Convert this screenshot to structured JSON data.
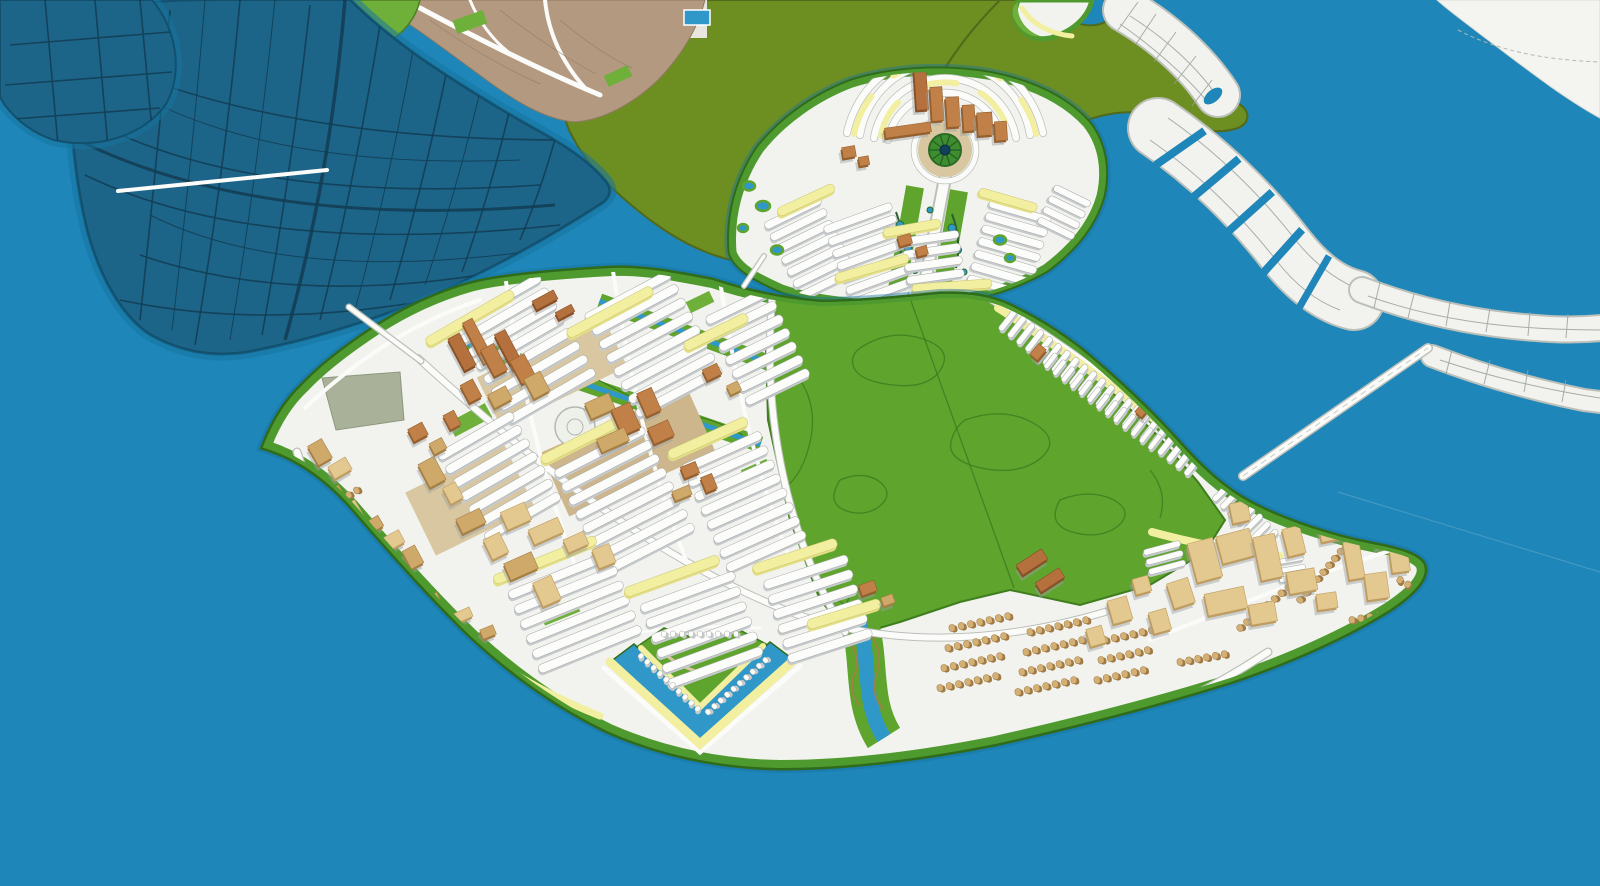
{
  "colors": {
    "water": "#1e86b8",
    "waterEdge": "#17749f",
    "darkIsland": "#1c6589",
    "darkIslandLine": "#123c52",
    "oliveLand": "#6d8e21",
    "oliveEdge": "#51691a",
    "parkGreen": "#5ea42d",
    "parkLine": "#3c7a1e",
    "shoreGreen": "#4f9a2e",
    "shoreDark": "#2f6b1a",
    "brightGreen": "#6fb03a",
    "landWhite": "#f2f3ee",
    "roadWhite": "#fbfbf9",
    "roadCasing": "#bcc0ba",
    "blockLine": "#9aa09e",
    "slabTop": "#fcfcfa",
    "slabSide": "#c6cacc",
    "slabLine": "#a2a7a6",
    "yellow": "#f2efa0",
    "yellowDeep": "#e4df86",
    "tan": "#e3c98f",
    "tanSide": "#bf9d62",
    "tanDark": "#cfa96a",
    "tanDarkSide": "#a67f44",
    "brown": "#c08048",
    "brownSide": "#95602e",
    "red": "#b5713d",
    "redSide": "#8a4f26",
    "houseTan": "#d4b075",
    "houseTanSide": "#a07a45",
    "sand": "#d8c7a0",
    "sandDeep": "#cdb68c",
    "canal": "#2f98c9",
    "sage": "#a9b299",
    "shadow": "#9aa0a3",
    "mainland": "#b3997f",
    "mainlandLine": "#8f7a62"
  },
  "rows": [
    {
      "p": "g-rows-main",
      "x": 497,
      "y": 302,
      "a": -30,
      "l": 100,
      "w": 9,
      "n": 8,
      "pt": 15.5
    },
    {
      "p": "g-rows-main",
      "x": 628,
      "y": 296,
      "a": -28,
      "l": 96,
      "w": 9,
      "n": 8,
      "pt": 15.5
    },
    {
      "p": "g-rows-main",
      "x": 738,
      "y": 306,
      "a": -26,
      "l": 70,
      "w": 9,
      "n": 7,
      "pt": 15
    },
    {
      "p": "g-rows-main",
      "x": 476,
      "y": 436,
      "a": -30,
      "l": 86,
      "w": 9,
      "n": 7,
      "pt": 15.5
    },
    {
      "p": "g-rows-main",
      "x": 600,
      "y": 452,
      "a": -27,
      "l": 100,
      "w": 9,
      "n": 8,
      "pt": 15.5
    },
    {
      "p": "g-rows-main",
      "x": 722,
      "y": 452,
      "a": -24,
      "l": 86,
      "w": 9,
      "n": 8,
      "pt": 15.5
    },
    {
      "p": "g-rows-main",
      "x": 560,
      "y": 575,
      "a": -22,
      "l": 110,
      "w": 9,
      "n": 6,
      "pt": 16
    },
    {
      "p": "g-rows-main",
      "x": 688,
      "y": 592,
      "a": -20,
      "l": 100,
      "w": 9,
      "n": 6,
      "pt": 16
    },
    {
      "p": "g-rows-main",
      "x": 806,
      "y": 572,
      "a": -18,
      "l": 88,
      "w": 9,
      "n": 6,
      "pt": 15.5
    },
    {
      "p": "g-rows-main",
      "x": 470,
      "y": 318,
      "a": -30,
      "l": 100,
      "w": 10,
      "n": 1,
      "f": "y"
    },
    {
      "p": "g-rows-main",
      "x": 610,
      "y": 312,
      "a": -28,
      "l": 96,
      "w": 10,
      "n": 1,
      "f": "y"
    },
    {
      "p": "g-rows-main",
      "x": 716,
      "y": 332,
      "a": -26,
      "l": 70,
      "w": 10,
      "n": 1,
      "f": "y"
    },
    {
      "p": "g-rows-main",
      "x": 586,
      "y": 438,
      "a": -27,
      "l": 100,
      "w": 10,
      "n": 1,
      "f": "y"
    },
    {
      "p": "g-rows-main",
      "x": 708,
      "y": 438,
      "a": -24,
      "l": 86,
      "w": 10,
      "n": 1,
      "f": "y"
    },
    {
      "p": "g-rows-main",
      "x": 545,
      "y": 560,
      "a": -22,
      "l": 110,
      "w": 10,
      "n": 1,
      "f": "y"
    },
    {
      "p": "g-rows-main",
      "x": 672,
      "y": 576,
      "a": -20,
      "l": 100,
      "w": 10,
      "n": 1,
      "f": "y"
    },
    {
      "p": "g-rows-main",
      "x": 795,
      "y": 556,
      "a": -18,
      "l": 88,
      "w": 10,
      "n": 1,
      "f": "y"
    },
    {
      "p": "g-rows-main",
      "x": 844,
      "y": 614,
      "a": -17,
      "l": 76,
      "w": 10,
      "n": 1,
      "f": "y"
    },
    {
      "p": "g-rows-main",
      "x": 1008,
      "y": 320,
      "a": -52,
      "l": 26,
      "w": 6,
      "n": 22,
      "pt": 11.2
    },
    {
      "p": "g-rows-main",
      "x": 1042,
      "y": 354,
      "a": -52,
      "l": 18,
      "w": 5,
      "n": 14,
      "pt": 11
    },
    {
      "p": "g-rows-main",
      "x": 1222,
      "y": 492,
      "a": -45,
      "l": 24,
      "w": 6,
      "n": 7,
      "pt": 11
    },
    {
      "p": "g-rows-main",
      "x": 1162,
      "y": 548,
      "a": -15,
      "l": 38,
      "w": 6,
      "n": 3,
      "pt": 10
    },
    {
      "p": "g-rows-main",
      "x": 1290,
      "y": 560,
      "a": -10,
      "l": 28,
      "w": 5,
      "n": 3,
      "pt": 9
    },
    {
      "p": "g-rows-upper",
      "x": 793,
      "y": 213,
      "a": -26,
      "l": 62,
      "w": 8,
      "n": 7,
      "pt": 13
    },
    {
      "p": "g-rows-upper",
      "x": 858,
      "y": 218,
      "a": -20,
      "l": 72,
      "w": 8,
      "n": 7,
      "pt": 13
    },
    {
      "p": "g-rows-upper",
      "x": 930,
      "y": 238,
      "a": -8,
      "l": 58,
      "w": 8,
      "n": 5,
      "pt": 13
    },
    {
      "p": "g-rows-upper",
      "x": 1020,
      "y": 212,
      "a": 16,
      "l": 64,
      "w": 8,
      "n": 7,
      "pt": 13
    },
    {
      "p": "g-rows-upper",
      "x": 1072,
      "y": 196,
      "a": 26,
      "l": 40,
      "w": 7,
      "n": 4,
      "pt": 12
    },
    {
      "p": "g-rows-upper",
      "x": 806,
      "y": 200,
      "a": -25,
      "l": 62,
      "w": 9,
      "n": 1,
      "f": "y"
    },
    {
      "p": "g-rows-upper",
      "x": 912,
      "y": 228,
      "a": -10,
      "l": 58,
      "w": 9,
      "n": 1,
      "f": "y"
    },
    {
      "p": "g-rows-upper",
      "x": 1008,
      "y": 200,
      "a": 16,
      "l": 60,
      "w": 9,
      "n": 1,
      "f": "y"
    },
    {
      "p": "g-rows-upper",
      "x": 872,
      "y": 268,
      "a": -16,
      "l": 76,
      "w": 9,
      "n": 1,
      "f": "y"
    },
    {
      "p": "g-rows-upper",
      "x": 952,
      "y": 286,
      "a": -4,
      "l": 80,
      "w": 9,
      "n": 1,
      "f": "y"
    },
    {
      "p": "g-rows-houses",
      "x": 952,
      "y": 628,
      "a": -102,
      "l": 7,
      "w": 6,
      "n": 7,
      "pt": 9.5,
      "f": "h"
    },
    {
      "p": "g-rows-houses",
      "x": 948,
      "y": 648,
      "a": -102,
      "l": 7,
      "w": 6,
      "n": 7,
      "pt": 9.5,
      "f": "h"
    },
    {
      "p": "g-rows-houses",
      "x": 944,
      "y": 668,
      "a": -102,
      "l": 7,
      "w": 6,
      "n": 7,
      "pt": 9.5,
      "f": "h"
    },
    {
      "p": "g-rows-houses",
      "x": 940,
      "y": 688,
      "a": -102,
      "l": 7,
      "w": 6,
      "n": 7,
      "pt": 9.5,
      "f": "h"
    },
    {
      "p": "g-rows-houses",
      "x": 1030,
      "y": 632,
      "a": -102,
      "l": 7,
      "w": 6,
      "n": 7,
      "pt": 9.5,
      "f": "h"
    },
    {
      "p": "g-rows-houses",
      "x": 1026,
      "y": 652,
      "a": -102,
      "l": 7,
      "w": 6,
      "n": 7,
      "pt": 9.5,
      "f": "h"
    },
    {
      "p": "g-rows-houses",
      "x": 1022,
      "y": 672,
      "a": -102,
      "l": 7,
      "w": 6,
      "n": 7,
      "pt": 9.5,
      "f": "h"
    },
    {
      "p": "g-rows-houses",
      "x": 1018,
      "y": 692,
      "a": -102,
      "l": 7,
      "w": 6,
      "n": 7,
      "pt": 9.5,
      "f": "h"
    },
    {
      "p": "g-rows-houses",
      "x": 1105,
      "y": 640,
      "a": -102,
      "l": 7,
      "w": 6,
      "n": 6,
      "pt": 9.5,
      "f": "h"
    },
    {
      "p": "g-rows-houses",
      "x": 1101,
      "y": 660,
      "a": -102,
      "l": 7,
      "w": 6,
      "n": 6,
      "pt": 9.5,
      "f": "h"
    },
    {
      "p": "g-rows-houses",
      "x": 1097,
      "y": 680,
      "a": -102,
      "l": 7,
      "w": 6,
      "n": 6,
      "pt": 9.5,
      "f": "h"
    },
    {
      "p": "g-rows-houses",
      "x": 302,
      "y": 522,
      "a": -120,
      "l": 7,
      "w": 5.5,
      "n": 8,
      "pt": 9,
      "f": "h"
    },
    {
      "p": "g-rows-houses",
      "x": 318,
      "y": 556,
      "a": -120,
      "l": 7,
      "w": 5.5,
      "n": 8,
      "pt": 9,
      "f": "h"
    },
    {
      "p": "g-rows-houses",
      "x": 344,
      "y": 598,
      "a": -118,
      "l": 7,
      "w": 5.5,
      "n": 8,
      "pt": 9,
      "f": "h"
    },
    {
      "p": "g-rows-houses",
      "x": 374,
      "y": 634,
      "a": -118,
      "l": 7,
      "w": 5.5,
      "n": 7,
      "pt": 9,
      "f": "h"
    },
    {
      "p": "g-rows-houses",
      "x": 1240,
      "y": 628,
      "a": -130,
      "l": 7,
      "w": 6,
      "n": 10,
      "pt": 9,
      "f": "h"
    },
    {
      "p": "g-rows-houses",
      "x": 1300,
      "y": 600,
      "a": -140,
      "l": 7,
      "w": 6,
      "n": 8,
      "pt": 9,
      "f": "h"
    },
    {
      "p": "g-rows-houses",
      "x": 1352,
      "y": 620,
      "a": -100,
      "l": 7,
      "w": 6,
      "n": 7,
      "pt": 9,
      "f": "h"
    },
    {
      "p": "g-rows-houses",
      "x": 1400,
      "y": 580,
      "a": -60,
      "l": 7,
      "w": 6,
      "n": 6,
      "pt": 9,
      "f": "h"
    },
    {
      "p": "g-rows-houses",
      "x": 1180,
      "y": 662,
      "a": -100,
      "l": 7,
      "w": 6,
      "n": 6,
      "pt": 9,
      "f": "h"
    },
    {
      "p": "g-rows-marina",
      "x": 641,
      "y": 656,
      "a": -47,
      "l": 6,
      "w": 5,
      "n": 10,
      "pt": 8.6
    },
    {
      "p": "g-rows-marina",
      "x": 708,
      "y": 712,
      "a": -132,
      "l": 6,
      "w": 5,
      "n": 10,
      "pt": 8.6
    },
    {
      "p": "g-rows-marina",
      "x": 664,
      "y": 634,
      "a": -90,
      "l": 6,
      "w": 5,
      "n": 9,
      "pt": 9
    }
  ],
  "buildings": {
    "downtown": [
      [
        462,
        352,
        13,
        36,
        -28,
        "red"
      ],
      [
        478,
        341,
        11,
        46,
        -28,
        "brown"
      ],
      [
        494,
        360,
        15,
        30,
        -28,
        "brown"
      ],
      [
        509,
        350,
        12,
        40,
        -28,
        "red"
      ],
      [
        523,
        369,
        16,
        26,
        -28,
        "brown"
      ],
      [
        537,
        385,
        18,
        22,
        -28,
        "tanDark"
      ],
      [
        471,
        391,
        14,
        20,
        -28,
        "brown"
      ],
      [
        500,
        397,
        20,
        15,
        -28,
        "tanDark"
      ],
      [
        545,
        300,
        24,
        10,
        -28,
        "red"
      ],
      [
        565,
        312,
        18,
        8,
        -28,
        "red"
      ],
      [
        600,
        406,
        26,
        17,
        -24,
        "tanDark"
      ],
      [
        626,
        419,
        20,
        28,
        -24,
        "brown"
      ],
      [
        649,
        402,
        16,
        25,
        -24,
        "brown"
      ],
      [
        613,
        440,
        30,
        14,
        -24,
        "tanDark"
      ],
      [
        661,
        432,
        22,
        17,
        -24,
        "brown"
      ],
      [
        690,
        470,
        16,
        12,
        -22,
        "brown"
      ],
      [
        709,
        483,
        12,
        16,
        -22,
        "brown"
      ],
      [
        682,
        493,
        18,
        10,
        -22,
        "tanDark"
      ],
      [
        516,
        516,
        26,
        19,
        -24,
        "tan"
      ],
      [
        546,
        531,
        32,
        16,
        -24,
        "tan"
      ],
      [
        576,
        542,
        22,
        14,
        -24,
        "tan"
      ],
      [
        604,
        556,
        18,
        20,
        -22,
        "tan"
      ],
      [
        418,
        432,
        16,
        14,
        -28,
        "brown"
      ],
      [
        438,
        446,
        14,
        12,
        -28,
        "tanDark"
      ],
      [
        452,
        420,
        12,
        16,
        -28,
        "brown"
      ]
    ],
    "east": [
      [
        1205,
        560,
        26,
        40,
        -15,
        "tan"
      ],
      [
        1236,
        546,
        34,
        28,
        -15,
        "tan"
      ],
      [
        1268,
        557,
        22,
        44,
        -12,
        "tan"
      ],
      [
        1294,
        541,
        18,
        28,
        -14,
        "tan"
      ],
      [
        1226,
        601,
        40,
        22,
        -12,
        "tan"
      ],
      [
        1263,
        613,
        26,
        20,
        -10,
        "tan"
      ],
      [
        1181,
        593,
        22,
        26,
        -18,
        "tan"
      ],
      [
        1160,
        621,
        18,
        22,
        -16,
        "tan"
      ],
      [
        1302,
        581,
        28,
        22,
        -10,
        "tan"
      ],
      [
        1327,
        601,
        20,
        16,
        -8,
        "tan"
      ],
      [
        1354,
        560,
        16,
        38,
        -10,
        "tan"
      ],
      [
        1377,
        586,
        22,
        26,
        -8,
        "tan"
      ],
      [
        1400,
        561,
        18,
        22,
        -8,
        "tan"
      ],
      [
        1341,
        521,
        46,
        34,
        -12,
        "tan"
      ],
      [
        1386,
        538,
        20,
        16,
        -10,
        "tan"
      ],
      [
        1032,
        562,
        30,
        12,
        -33,
        "red"
      ],
      [
        1050,
        580,
        28,
        11,
        -33,
        "red"
      ],
      [
        1240,
        512,
        18,
        20,
        -12,
        "tan"
      ],
      [
        1120,
        610,
        20,
        24,
        -16,
        "tan"
      ],
      [
        1096,
        636,
        16,
        18,
        -16,
        "tan"
      ],
      [
        1142,
        585,
        16,
        16,
        -16,
        "tan"
      ]
    ],
    "west": [
      [
        320,
        452,
        16,
        22,
        -30,
        "tanDark"
      ],
      [
        340,
        468,
        20,
        14,
        -30,
        "tan"
      ],
      [
        302,
        480,
        12,
        18,
        -30,
        "tanDark"
      ],
      [
        331,
        496,
        24,
        12,
        -30,
        "tanDark"
      ],
      [
        353,
        511,
        14,
        18,
        -30,
        "tan"
      ],
      [
        373,
        525,
        18,
        12,
        -30,
        "tanDark"
      ],
      [
        392,
        541,
        22,
        14,
        -28,
        "tan"
      ],
      [
        413,
        557,
        14,
        20,
        -28,
        "tanDark"
      ],
      [
        432,
        472,
        18,
        26,
        -28,
        "tanDark"
      ],
      [
        453,
        493,
        14,
        18,
        -28,
        "tan"
      ],
      [
        471,
        521,
        26,
        16,
        -26,
        "tanDark"
      ],
      [
        496,
        546,
        18,
        22,
        -26,
        "tan"
      ],
      [
        521,
        566,
        30,
        18,
        -24,
        "tanDark"
      ],
      [
        547,
        591,
        20,
        26,
        -24,
        "tan"
      ],
      [
        432,
        601,
        16,
        12,
        -24,
        "tanDark"
      ],
      [
        461,
        616,
        22,
        10,
        -24,
        "tan"
      ],
      [
        488,
        632,
        14,
        10,
        -22,
        "tanDark"
      ]
    ],
    "upper": [
      [
        921,
        86,
        12,
        48,
        -4,
        "red"
      ],
      [
        937,
        104,
        12,
        34,
        -4,
        "brown"
      ],
      [
        953,
        112,
        13,
        30,
        -4,
        "brown"
      ],
      [
        969,
        118,
        12,
        26,
        -4,
        "brown"
      ],
      [
        985,
        124,
        15,
        23,
        -4,
        "brown"
      ],
      [
        1001,
        131,
        12,
        19,
        -4,
        "brown"
      ],
      [
        908,
        130,
        46,
        10,
        -8,
        "brown"
      ],
      [
        849,
        152,
        13,
        11,
        -10,
        "brown"
      ],
      [
        864,
        161,
        10,
        9,
        -10,
        "brown"
      ],
      [
        905,
        240,
        13,
        10,
        -15,
        "brown"
      ],
      [
        922,
        251,
        11,
        9,
        -15,
        "brown"
      ]
    ],
    "misc": [
      [
        1038,
        352,
        14,
        10,
        -50,
        "brown"
      ],
      [
        1142,
        410,
        12,
        9,
        -50,
        "brown"
      ],
      [
        1220,
        442,
        10,
        11,
        -48,
        "brown"
      ],
      [
        1234,
        457,
        10,
        9,
        -48,
        "brown"
      ],
      [
        868,
        588,
        16,
        11,
        -20,
        "brown"
      ],
      [
        888,
        600,
        12,
        9,
        -20,
        "tanDark"
      ],
      [
        712,
        372,
        16,
        12,
        -26,
        "brown"
      ],
      [
        734,
        388,
        12,
        10,
        -26,
        "tanDark"
      ]
    ]
  },
  "upper_ponds": [
    [
      749,
      186,
      6,
      4.5
    ],
    [
      763,
      206,
      7,
      5
    ],
    [
      743,
      228,
      5,
      4
    ],
    [
      777,
      250,
      6,
      4.5
    ],
    [
      1000,
      240,
      6,
      4.5
    ],
    [
      1010,
      258,
      5,
      4
    ]
  ],
  "axis_ponds": [
    [
      900,
      225,
      4
    ],
    [
      908,
      248,
      4
    ],
    [
      915,
      270,
      3.5
    ],
    [
      952,
      228,
      4
    ],
    [
      958,
      250,
      3.5
    ],
    [
      964,
      272,
      3
    ],
    [
      930,
      210,
      3
    ]
  ],
  "plaza": {
    "cx": 945,
    "cy": 150,
    "spokes": 10
  }
}
